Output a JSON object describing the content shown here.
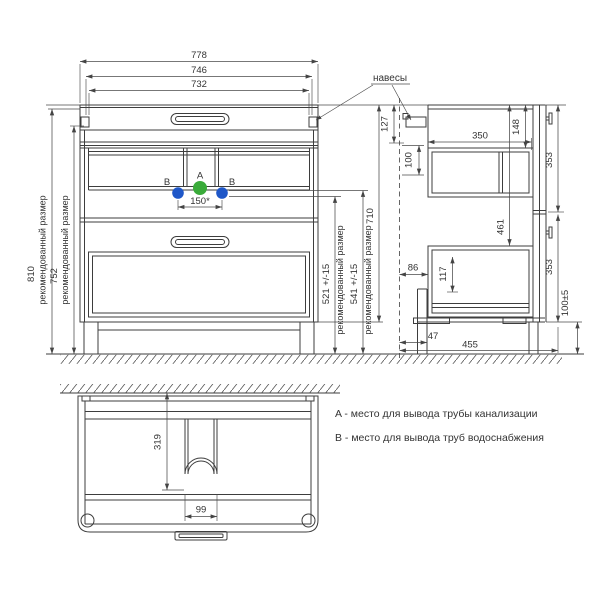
{
  "front": {
    "d778": "778",
    "d746": "746",
    "d732": "732",
    "d810": "810",
    "d752": "752",
    "rec": "рекомендованный размер",
    "d150": "150*",
    "d521": "521 +/-15",
    "d541": "541 +/-15",
    "d710": "710",
    "a": "A",
    "b": "B",
    "hangers": "навесы"
  },
  "side": {
    "d127": "127",
    "d100": "100",
    "d350": "350",
    "d148": "148",
    "d353": "353",
    "d461": "461",
    "d86": "86",
    "d117": "117",
    "d100t": "100±5",
    "d47": "47",
    "d455": "455"
  },
  "plan": {
    "d319": "319",
    "d99": "99"
  },
  "legend": {
    "a": "A - место для вывода трубы канализации",
    "b": "B - место для вывода труб водоснабжения"
  },
  "colors": {
    "line": "#3d3d3d",
    "marker_a": "#3aab3a",
    "marker_b": "#1f57c8"
  }
}
